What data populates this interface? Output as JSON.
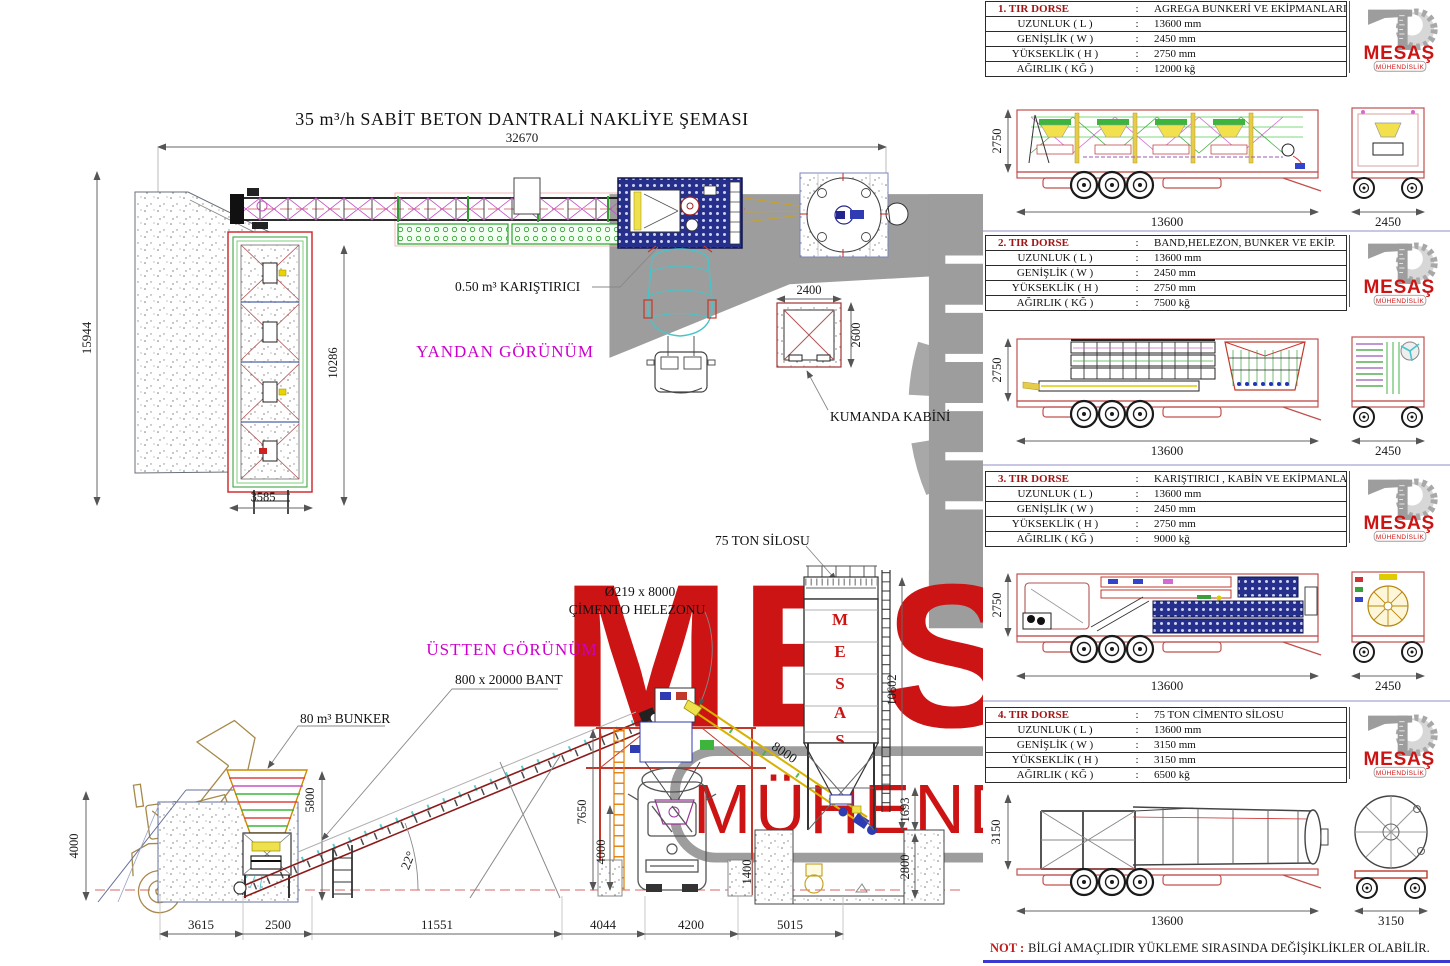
{
  "title": "35 m³/h SABİT BETON DANTRALİ NAKLİYE ŞEMASI",
  "colon": ":",
  "logo": {
    "name": "MESAŞ",
    "sub": "MÜHENDİSLİK"
  },
  "note": {
    "prefix": "NOT :",
    "text": "BİLGİ AMAÇLIDIR YÜKLEME SIRASINDA DEĞİŞİKLİKLER OLABİLİR."
  },
  "side_view": {
    "label": "YANDAN GÖRÜNÜM",
    "mixer_label": "0.50 m³ KARIŞTIRICI",
    "cabin_label": "KUMANDA KABİNİ",
    "dims": {
      "total_length": "32670",
      "total_height": "15944",
      "bunker_length": "10286",
      "bunker_width": "3585",
      "cabin_width": "2400",
      "cabin_depth": "2600"
    }
  },
  "top_view": {
    "label": "ÜSTTEN GÖRÜNÜM",
    "bunker_label": "80 m³ BUNKER",
    "belt_label": "800 x 20000 BANT",
    "helezon_label_line1": "Ø219 x 8000",
    "helezon_label_line2": "ÇİMENTO HELEZONU",
    "silo_label": "75 TON SİLOSU",
    "silo_letters": [
      "M",
      "E",
      "S",
      "A",
      "Ş"
    ],
    "dims": {
      "ramp_height": "4000",
      "bunker_height": "5800",
      "belt_angle": "22°",
      "plant_height": "7650",
      "clearance": "4000",
      "footing": "1400",
      "helezon_length": "8000",
      "silo_height": "10602",
      "silo_legs": "1693",
      "pit_depth": "2800",
      "seg1": "3615",
      "seg2": "2500",
      "seg3": "11551",
      "seg4": "4044",
      "seg5": "4200",
      "seg6": "5015"
    }
  },
  "trailers": [
    {
      "no": "1. TIR DORSE",
      "cargo": "AGREGA BUNKERİ VE EKİPMANLARI",
      "rows": [
        {
          "label": "UZUNLUK ( L )",
          "value": "13600 mm"
        },
        {
          "label": "GENİŞLİK ( W )",
          "value": "2450 mm"
        },
        {
          "label": "YÜKSEKLİK ( H )",
          "value": "2750 mm"
        },
        {
          "label": "AĞIRLIK ( KĞ )",
          "value": "12000 kğ"
        }
      ],
      "dims": {
        "height": "2750",
        "length": "13600",
        "width": "2450"
      }
    },
    {
      "no": "2. TIR DORSE",
      "cargo": "BAND,HELEZON, BUNKER VE EKİP.",
      "rows": [
        {
          "label": "UZUNLUK ( L )",
          "value": "13600 mm"
        },
        {
          "label": "GENİŞLİK ( W )",
          "value": "2450 mm"
        },
        {
          "label": "YÜKSEKLİK ( H )",
          "value": "2750 mm"
        },
        {
          "label": "AĞIRLIK ( KĞ )",
          "value": "7500 kğ"
        }
      ],
      "dims": {
        "height": "2750",
        "length": "13600",
        "width": "2450"
      }
    },
    {
      "no": "3. TIR DORSE",
      "cargo": "KARIŞTIRICI , KABİN VE EKİPMANLARI",
      "rows": [
        {
          "label": "UZUNLUK ( L )",
          "value": "13600 mm"
        },
        {
          "label": "GENİŞLİK ( W )",
          "value": "2450 mm"
        },
        {
          "label": "YÜKSEKLİK ( H )",
          "value": "2750 mm"
        },
        {
          "label": "AĞIRLIK ( KĞ )",
          "value": "9000 kğ"
        }
      ],
      "dims": {
        "height": "2750",
        "length": "13600",
        "width": "2450"
      }
    },
    {
      "no": "4. TIR DORSE",
      "cargo": "75 TON CİMENTO SİLOSU",
      "rows": [
        {
          "label": "UZUNLUK ( L )",
          "value": "13600 mm"
        },
        {
          "label": "GENİŞLİK ( W )",
          "value": "3150 mm"
        },
        {
          "label": "YÜKSEKLİK ( H )",
          "value": "3150 mm"
        },
        {
          "label": "AĞIRLIK ( KĞ )",
          "value": "6500 kğ"
        }
      ],
      "dims": {
        "height": "3150",
        "length": "13600",
        "width": "3150"
      }
    }
  ]
}
